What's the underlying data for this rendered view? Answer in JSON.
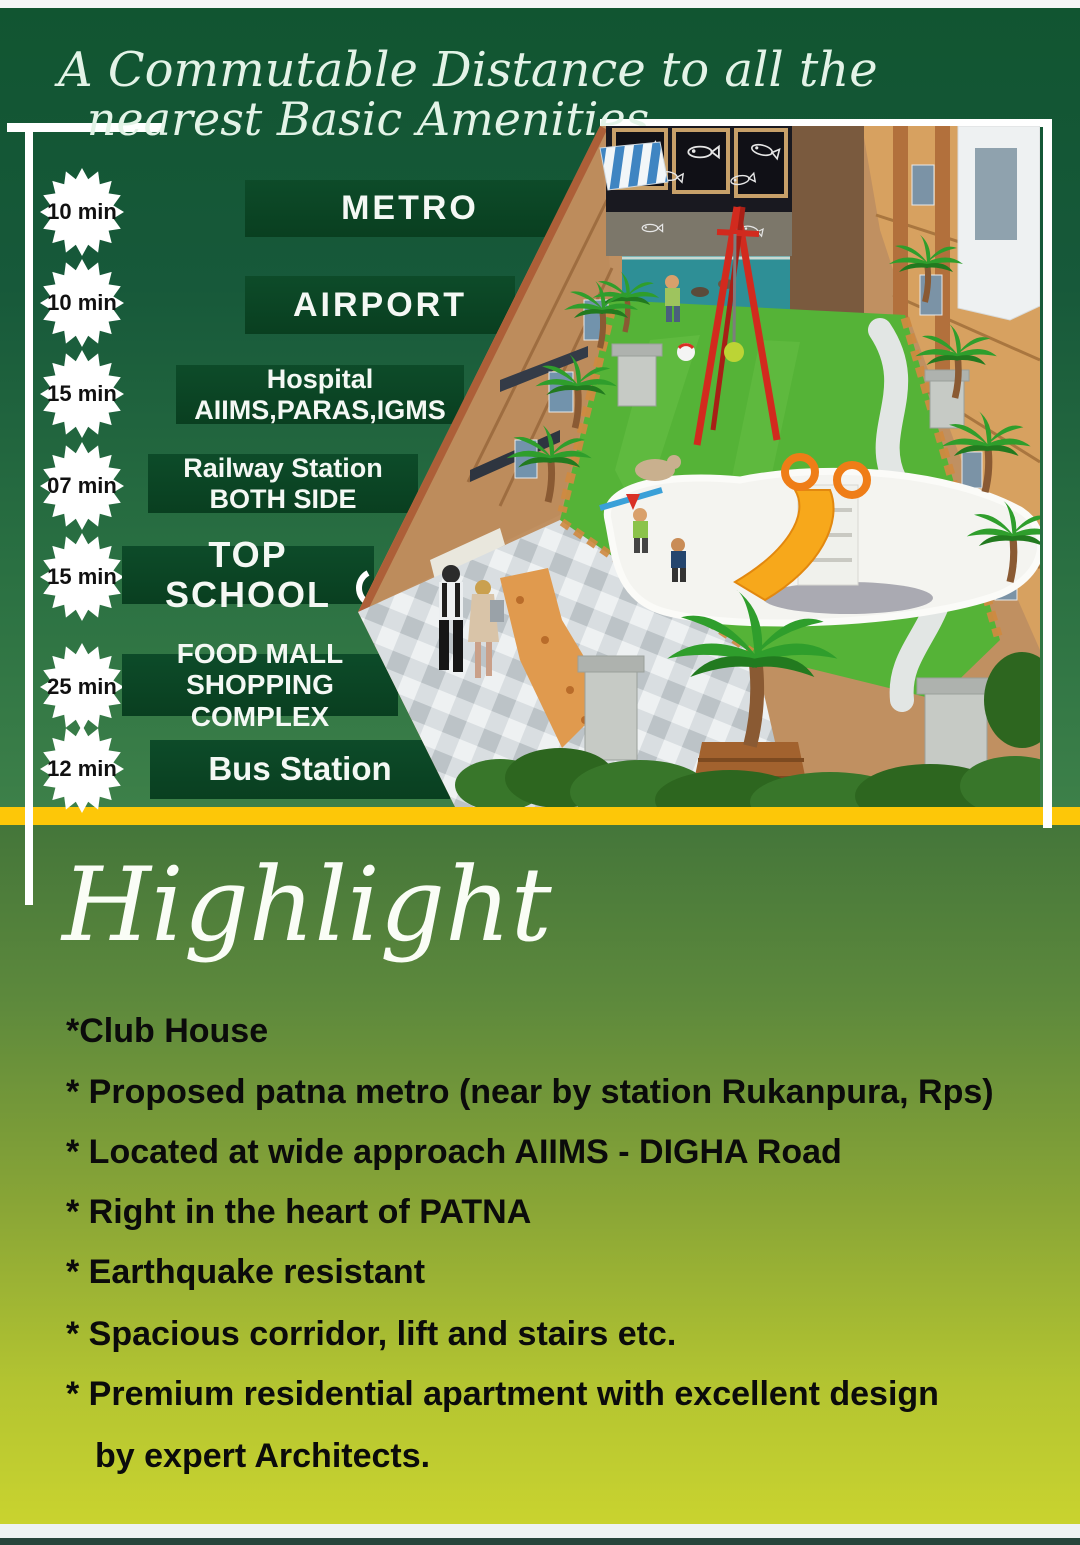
{
  "header": {
    "title_line1": "A Commutable Distance to all the",
    "title_line2": "nearest Basic Amenities"
  },
  "amenities": [
    {
      "time": "10 min",
      "lines": [
        "METRO"
      ]
    },
    {
      "time": "10 min",
      "lines": [
        "AIRPORT"
      ]
    },
    {
      "time": "15 min",
      "lines": [
        "Hospital",
        "AIIMS,PARAS,IGMS"
      ]
    },
    {
      "time": "07 min",
      "lines": [
        "Railway Station",
        "BOTH SIDE"
      ]
    },
    {
      "time": "15 min",
      "lines": [
        "TOP SCHOOL"
      ]
    },
    {
      "time": "25 min",
      "lines": [
        "FOOD MALL",
        "SHOPPING COMPLEX"
      ]
    },
    {
      "time": "12 min",
      "lines": [
        "Bus Station"
      ]
    }
  ],
  "highlight": {
    "heading": "Highlight",
    "bullets": [
      "*Club House",
      "* Proposed patna metro (near by station Rukanpura, Rps)",
      "* Located at wide approach AIIMS - DIGHA Road",
      "* Right in the heart of PATNA",
      "* Earthquake resistant",
      "* Spacious corridor, lift and stairs etc.",
      "* Premium residential apartment with excellent design",
      "by expert Architects."
    ]
  },
  "colors": {
    "accent_yellow": "#fdc708",
    "panel_green": "#0a4525",
    "footer_teal": "#27453b"
  }
}
